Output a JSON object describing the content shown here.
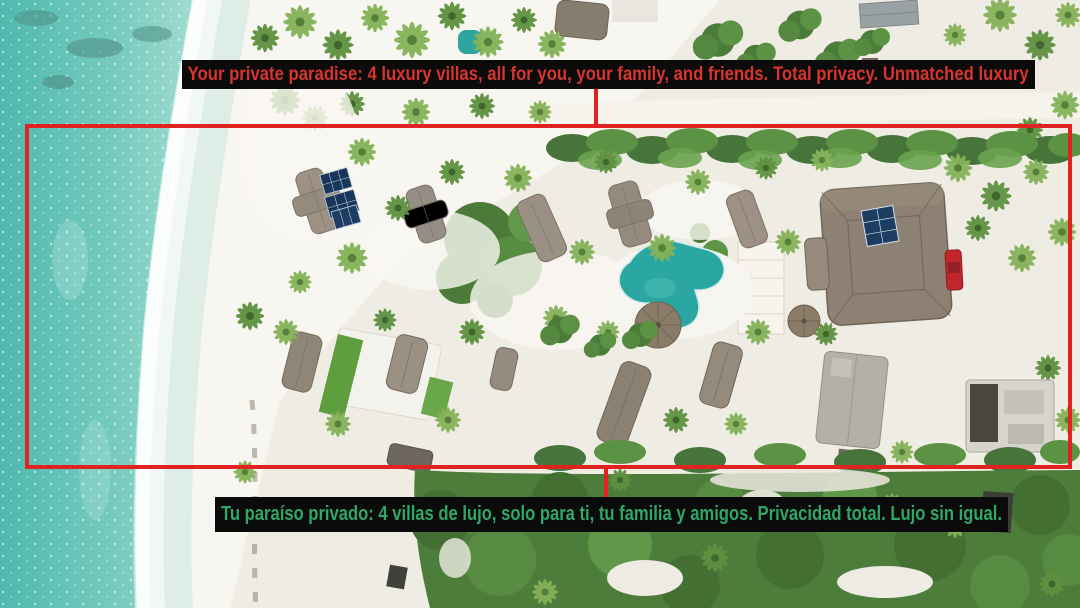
{
  "annotations": {
    "headline_en": {
      "text": "Your private paradise: 4 luxury villas, all for you, your family, and friends. Total privacy. Unmatched luxury",
      "text_color": "#d9342e",
      "bar_color": "#0b0b0b"
    },
    "headline_es": {
      "text": "Tu paraíso privado: 4 villas de lujo, solo para ti, tu familia y amigos. Privacidad total. Lujo sin igual.",
      "text_color": "#2fa766",
      "bar_color": "#0b0b0b"
    },
    "highlight_box": {
      "shape": "rectangle-outline",
      "color": "#e02320"
    }
  },
  "scene": {
    "type": "aerial-drone-photo",
    "subject": "beachfront resort: ocean shoreline, white sand beach, thatched-roof villas, swimming pool, palm trees, main lodge, solar panels, red car",
    "colors": {
      "ocean": "#56bdb2",
      "foam": "#ffffff",
      "sand": "#efece3",
      "vegetation": "#4d7d3a",
      "pool": "#2ba7a3",
      "roofs": "#938a7e",
      "solar_panels": "#17365a",
      "red_car": "#c1272d"
    }
  }
}
